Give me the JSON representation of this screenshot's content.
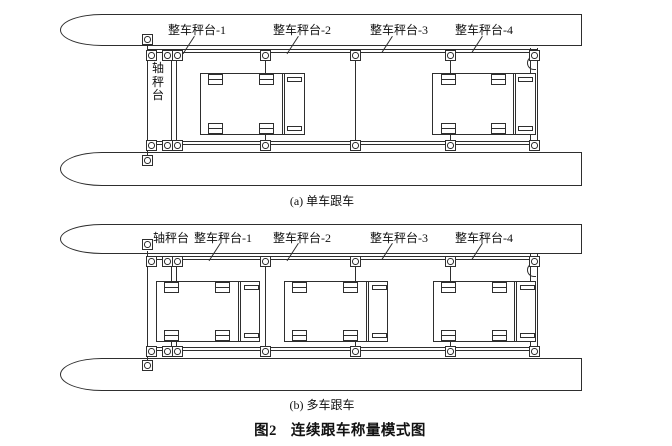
{
  "figure_caption": {
    "number": "图2",
    "title": "连续跟车称量模式图"
  },
  "diagram_a": {
    "subcaption": "(a) 单车跟车",
    "axle_scale_label": "轴秤台",
    "platform_labels": [
      "整车秤台-1",
      "整车秤台-2",
      "整车秤台-3",
      "整车秤台-4"
    ]
  },
  "diagram_b": {
    "subcaption": "(b) 多车跟车",
    "axle_scale_label": "轴秤台",
    "platform_labels": [
      "整车秤台-1",
      "整车秤台-2",
      "整车秤台-3",
      "整车秤台-4"
    ]
  },
  "colors": {
    "line": "#2e2e2e",
    "background": "#ffffff"
  }
}
